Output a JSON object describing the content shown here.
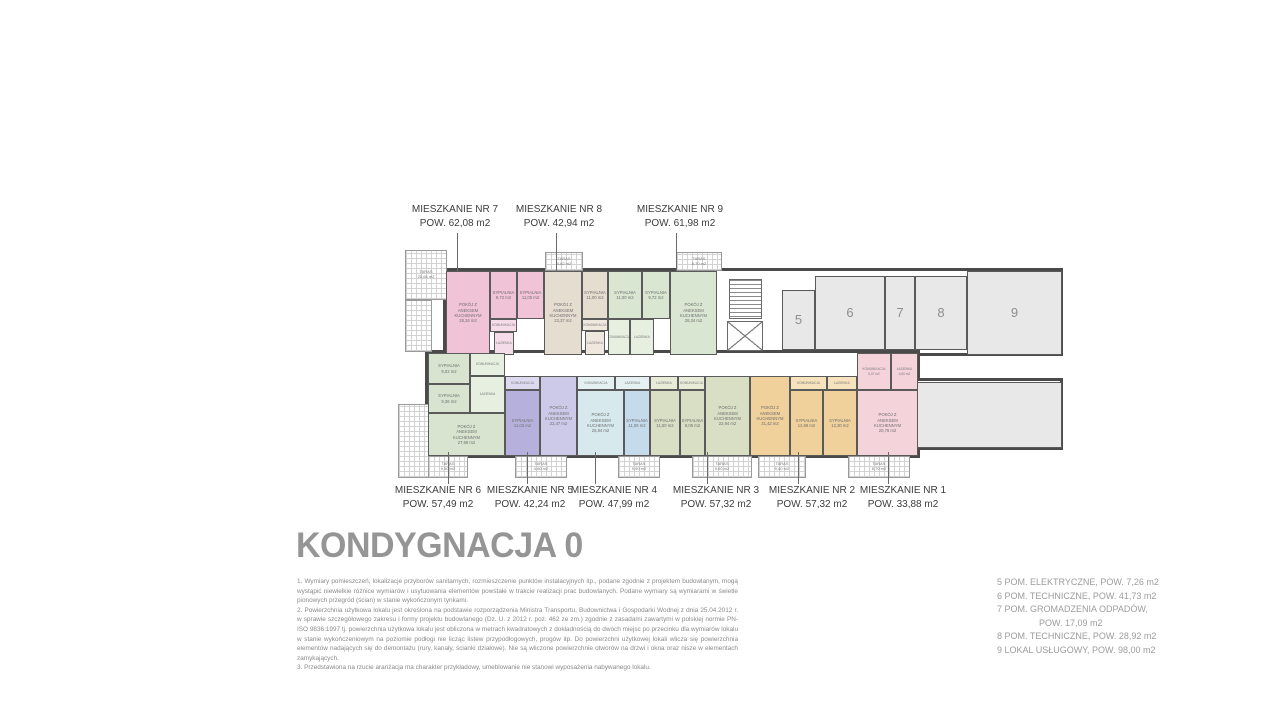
{
  "title": "KONDYGNACJA 0",
  "callouts": {
    "top": [
      {
        "name": "apartment-label-7",
        "title": "MIESZKANIE NR 7",
        "area": "POW. 62,08 m2",
        "cx": 455,
        "leader_x": 457
      },
      {
        "name": "apartment-label-8",
        "title": "MIESZKANIE NR 8",
        "area": "POW. 42,94 m2",
        "cx": 559,
        "leader_x": 556
      },
      {
        "name": "apartment-label-9",
        "title": "MIESZKANIE NR 9",
        "area": "POW. 61,98 m2",
        "cx": 680,
        "leader_x": 676
      }
    ],
    "bottom": [
      {
        "name": "apartment-label-6",
        "title": "MIESZKANIE NR 6",
        "area": "POW. 57,49 m2",
        "cx": 438,
        "leader_x": 448
      },
      {
        "name": "apartment-label-5",
        "title": "MIESZKANIE NR 5",
        "area": "POW. 42,24 m2",
        "cx": 530,
        "leader_x": 527
      },
      {
        "name": "apartment-label-4",
        "title": "MIESZKANIE NR 4",
        "area": "POW. 47,99 m2",
        "cx": 614,
        "leader_x": 595
      },
      {
        "name": "apartment-label-3",
        "title": "MIESZKANIE NR 3",
        "area": "POW. 57,32 m2",
        "cx": 716,
        "leader_x": 707
      },
      {
        "name": "apartment-label-2",
        "title": "MIESZKANIE NR 2",
        "area": "POW. 57,32 m2",
        "cx": 812,
        "leader_x": 798
      },
      {
        "name": "apartment-label-1",
        "title": "MIESZKANIE NR 1",
        "area": "POW. 33,88 m2",
        "cx": 903,
        "leader_x": 888
      }
    ]
  },
  "legend": {
    "items": [
      {
        "text": "5 POM. ELEKTRYCZNE, POW. 7,26 m2"
      },
      {
        "text": "6 POM. TECHNICZNE, POW. 41,73 m2"
      },
      {
        "text": "7 POM. GROMADZENIA ODPADÓW,",
        "text2": "POW. 17,09 m2"
      },
      {
        "text": "8 POM. TECHNICZNE, POW. 28,92 m2"
      },
      {
        "text": "9 LOKAL USŁUGOWY, POW. 98,00 m2"
      }
    ]
  },
  "notes": [
    "1. Wymiary pomieszczeń, lokalizacje przyborów sanitarnych, rozmieszczenie punktów instalacyjnych itp., podane zgodnie z projektem budowlanym, mogą wystąpić niewielkie różnice wymiarów i usytuowania elementów powstałe w trakcie realizacji prac budowlanych. Podane wymiary są wymiarami w świetle pionowych przegród (ścian) w stanie wykończonym tynkami.",
    "2. Powierzchnia użytkowa lokalu jest określona na podstawie rozporządzenia Ministra Transportu, Budownictwa i Gospodarki Wodnej z dnia 25.04.2012 r. w sprawie szczegółowego zakresu i formy projektu budowlanego (Dz. U. z 2012 r. poz. 462 ze zm.) zgodnie z zasadami zawartymi w polskiej normie PN-ISO 9836:1997 tj. powierzchnia użytkowa lokalu jest obliczona w metrach kwadratowych z dokładnością do dwóch miejsc po przecinku dla wymiarów lokalu w stanie wykończeniowym na poziomie podłogi nie licząc listew przypodłogowych, progów itp. Do powierzchni użytkowej lokali wlicza się powierzchnia elementów nadających się do demontażu (rury, kanały, ścianki działowe). Nie są wliczone powierzchnie otworów na drzwi i okna oraz nisze w elementach zamykających.",
    "3. Przedstawiona na rzucie aranżacja ma charakter przykładowy, umeblowanie nie stanowi wyposażenia nabywanego lokalu."
  ],
  "plan": {
    "outlines": [
      {
        "name": "building-top-wing",
        "x": 443,
        "y": 268,
        "w": 620,
        "h": 88
      },
      {
        "name": "building-bottom-wing",
        "x": 425,
        "y": 350,
        "w": 495,
        "h": 108
      },
      {
        "name": "building-right-wing",
        "x": 885,
        "y": 378,
        "w": 178,
        "h": 72
      }
    ],
    "rooms": [
      {
        "name": "apt7-living",
        "label": "POKÓJ Z\nANEKSEM\nKUCHENNYM\n28,34 m2",
        "x": 446,
        "y": 271,
        "w": 44,
        "h": 84,
        "fill": "#f0c3d7"
      },
      {
        "name": "apt7-bedroom-1",
        "label": "SYPIALNIA\n9,72 m2",
        "x": 490,
        "y": 271,
        "w": 27,
        "h": 48,
        "fill": "#f0c3d7"
      },
      {
        "name": "apt7-bedroom-2",
        "label": "SYPIALNIA\n11,00 m2",
        "x": 517,
        "y": 271,
        "w": 27,
        "h": 48,
        "fill": "#f0c3d7"
      },
      {
        "name": "apt7-hall",
        "label": "KOMUNIKACJA",
        "x": 490,
        "y": 319,
        "w": 27,
        "h": 13,
        "fill": "#f6dce8",
        "wet": true
      },
      {
        "name": "apt7-bathroom",
        "label": "ŁAZIENKA",
        "x": 494,
        "y": 332,
        "w": 20,
        "h": 23,
        "fill": "#f6dce8",
        "wet": true
      },
      {
        "name": "apt8-living",
        "label": "POKÓJ Z\nANEKSEM\nKUCHENNYM\n23,37 m2",
        "x": 544,
        "y": 271,
        "w": 38,
        "h": 84,
        "fill": "#e6ddd1"
      },
      {
        "name": "apt8-bedroom",
        "label": "SYPIALNIA\n11,00 m2",
        "x": 582,
        "y": 271,
        "w": 26,
        "h": 48,
        "fill": "#e6ddd1"
      },
      {
        "name": "apt8-hall",
        "label": "KOMUNIKACJA",
        "x": 582,
        "y": 319,
        "w": 26,
        "h": 12,
        "fill": "#efe8df",
        "wet": true
      },
      {
        "name": "apt8-bathroom",
        "label": "ŁAZIENKA",
        "x": 585,
        "y": 331,
        "w": 20,
        "h": 24,
        "fill": "#efe8df",
        "wet": true
      },
      {
        "name": "apt9-bedroom-1",
        "label": "SYPIALNIA\n11,00 m2",
        "x": 608,
        "y": 271,
        "w": 34,
        "h": 48,
        "fill": "#d9e6d2"
      },
      {
        "name": "apt9-bedroom-2",
        "label": "SYPIALNIA\n9,72 m2",
        "x": 642,
        "y": 271,
        "w": 28,
        "h": 48,
        "fill": "#d9e6d2"
      },
      {
        "name": "apt9-living",
        "label": "POKÓJ Z\nANEKSEM\nKUCHENNYM\n28,34 m2",
        "x": 670,
        "y": 271,
        "w": 47,
        "h": 84,
        "fill": "#d9e6d2"
      },
      {
        "name": "apt9-hall",
        "label": "KOMUNIKACJA",
        "x": 608,
        "y": 319,
        "w": 22,
        "h": 36,
        "fill": "#e6efe0",
        "wet": true
      },
      {
        "name": "apt9-bathroom",
        "label": "ŁAZIENKA",
        "x": 630,
        "y": 319,
        "w": 24,
        "h": 36,
        "fill": "#e6efe0",
        "wet": true
      },
      {
        "name": "room-5-electrical",
        "label": "5",
        "x": 782,
        "y": 290,
        "w": 33,
        "h": 60,
        "fill": "#e8e8e8",
        "number": true
      },
      {
        "name": "room-6-technical",
        "label": "6",
        "x": 815,
        "y": 276,
        "w": 70,
        "h": 74,
        "fill": "#e8e8e8",
        "number": true
      },
      {
        "name": "room-7-waste",
        "label": "7",
        "x": 885,
        "y": 276,
        "w": 30,
        "h": 74,
        "fill": "#e8e8e8",
        "number": true
      },
      {
        "name": "room-8-technical",
        "label": "8",
        "x": 915,
        "y": 276,
        "w": 52,
        "h": 74,
        "fill": "#e8e8e8",
        "number": true
      },
      {
        "name": "room-9-service",
        "label": "9",
        "x": 967,
        "y": 271,
        "w": 95,
        "h": 84,
        "fill": "#e8e8e8",
        "number": true
      },
      {
        "name": "room-9-service-lower",
        "label": "",
        "x": 888,
        "y": 382,
        "w": 174,
        "h": 66,
        "fill": "#e8e8e8"
      },
      {
        "name": "apt6-bedroom-1",
        "label": "SYPIALNIA\n9,02 m2",
        "x": 428,
        "y": 353,
        "w": 42,
        "h": 31,
        "fill": "#d9e4d0"
      },
      {
        "name": "apt6-bedroom-2",
        "label": "SYPIALNIA\n9,36 m2",
        "x": 428,
        "y": 384,
        "w": 42,
        "h": 29,
        "fill": "#d9e4d0"
      },
      {
        "name": "apt6-living",
        "label": "POKÓJ Z\nANEKSEM\nKUCHENNYM\n27,68 m2",
        "x": 428,
        "y": 413,
        "w": 77,
        "h": 43,
        "fill": "#d9e4d0"
      },
      {
        "name": "apt6-hall",
        "label": "KOMUNIKACJA",
        "x": 470,
        "y": 353,
        "w": 35,
        "h": 23,
        "fill": "#e6efe0",
        "wet": true
      },
      {
        "name": "apt6-bathroom",
        "label": "ŁAZIENKA",
        "x": 470,
        "y": 376,
        "w": 35,
        "h": 37,
        "fill": "#e6efe0",
        "wet": true
      },
      {
        "name": "apt5-hall",
        "label": "KOMUNIKACJA",
        "x": 505,
        "y": 376,
        "w": 35,
        "h": 14,
        "fill": "#dddaf0",
        "wet": true
      },
      {
        "name": "apt5-bedroom",
        "label": "SYPIALNIA\n11,03 m2",
        "x": 505,
        "y": 390,
        "w": 35,
        "h": 66,
        "fill": "#b6b1dc"
      },
      {
        "name": "apt5-living",
        "label": "POKÓJ Z\nANEKSEM\nKUCHENNYM\n22,47 m2",
        "x": 540,
        "y": 376,
        "w": 37,
        "h": 80,
        "fill": "#cdcae9"
      },
      {
        "name": "apt4-hall",
        "label": "KOMUNIKACJA",
        "x": 577,
        "y": 376,
        "w": 38,
        "h": 14,
        "fill": "#e4f0f2",
        "wet": true
      },
      {
        "name": "apt4-bathroom",
        "label": "ŁAZIENKA",
        "x": 615,
        "y": 376,
        "w": 35,
        "h": 14,
        "fill": "#e4f0f2",
        "wet": true
      },
      {
        "name": "apt4-living",
        "label": "POKÓJ Z\nANEKSEM\nKUCHENNYM\n26,84 m2",
        "x": 577,
        "y": 390,
        "w": 47,
        "h": 66,
        "fill": "#d7e9ed"
      },
      {
        "name": "apt4-bedroom",
        "label": "SYPIALNIA\n11,06 m2",
        "x": 624,
        "y": 390,
        "w": 26,
        "h": 66,
        "fill": "#c5daeb"
      },
      {
        "name": "apt3-bathroom",
        "label": "ŁAZIENKA",
        "x": 650,
        "y": 376,
        "w": 28,
        "h": 14,
        "fill": "#e7ebd8",
        "wet": true
      },
      {
        "name": "apt3-hall",
        "label": "KOMUNIKACJA",
        "x": 678,
        "y": 376,
        "w": 27,
        "h": 14,
        "fill": "#e7ebd8",
        "wet": true
      },
      {
        "name": "apt3-bedroom-1",
        "label": "SYPIALNIA\n11,50 m2",
        "x": 650,
        "y": 390,
        "w": 30,
        "h": 66,
        "fill": "#d8dfc4"
      },
      {
        "name": "apt3-bedroom-2",
        "label": "SYPIALNIA\n8,05 m2",
        "x": 680,
        "y": 390,
        "w": 25,
        "h": 66,
        "fill": "#d8dfc4"
      },
      {
        "name": "apt3-living",
        "label": "POKÓJ Z\nANEKSEM\nKUCHENNYM\n22,94 m2",
        "x": 705,
        "y": 376,
        "w": 45,
        "h": 80,
        "fill": "#d8dfc4"
      },
      {
        "name": "apt2-living",
        "label": "POKÓJ Z\nANEKSEM\nKUCHENNYM\n31,42 m2",
        "x": 750,
        "y": 376,
        "w": 40,
        "h": 80,
        "fill": "#f0d09b"
      },
      {
        "name": "apt2-hall",
        "label": "KOMUNIKACJA",
        "x": 790,
        "y": 376,
        "w": 37,
        "h": 14,
        "fill": "#f6e2bd",
        "wet": true
      },
      {
        "name": "apt2-bathroom",
        "label": "ŁAZIENKA",
        "x": 827,
        "y": 376,
        "w": 30,
        "h": 14,
        "fill": "#f6e2bd",
        "wet": true
      },
      {
        "name": "apt2-bedroom-1",
        "label": "SYPIALNIA\n12,69 m2",
        "x": 790,
        "y": 390,
        "w": 33,
        "h": 66,
        "fill": "#f0d09b"
      },
      {
        "name": "apt2-bedroom-2",
        "label": "SYPIALNIA\n12,30 m2",
        "x": 823,
        "y": 390,
        "w": 34,
        "h": 66,
        "fill": "#f0d09b"
      },
      {
        "name": "apt1-hall",
        "label": "KOMUNIKACJA\n6,07 m2",
        "x": 857,
        "y": 353,
        "w": 34,
        "h": 37,
        "fill": "#f4d3da",
        "wet": true
      },
      {
        "name": "apt1-bathroom",
        "label": "ŁAZIENKA\n4,60 m2",
        "x": 891,
        "y": 353,
        "w": 27,
        "h": 37,
        "fill": "#f4d3da",
        "wet": true
      },
      {
        "name": "apt1-living",
        "label": "POKÓJ Z\nANEKSEM\nKUCHENNYM\n20,76 m2",
        "x": 857,
        "y": 390,
        "w": 61,
        "h": 66,
        "fill": "#f4d3da"
      }
    ],
    "terraces": [
      {
        "name": "terrace-top-left",
        "label": "TARAS\n20,66 m2",
        "x": 405,
        "y": 250,
        "w": 42,
        "h": 50
      },
      {
        "name": "terrace-left-side",
        "label": "",
        "x": 405,
        "y": 300,
        "w": 27,
        "h": 52
      },
      {
        "name": "terrace-top-apt8",
        "label": "TARAS\n4,82 m2",
        "x": 545,
        "y": 252,
        "w": 38,
        "h": 19
      },
      {
        "name": "terrace-top-apt9",
        "label": "TARAS\n8,70 m2",
        "x": 676,
        "y": 252,
        "w": 46,
        "h": 19
      },
      {
        "name": "terrace-bottom-left",
        "label": "",
        "x": 398,
        "y": 404,
        "w": 44,
        "h": 74
      },
      {
        "name": "terrace-apt6",
        "label": "TARAS\n9,50 m2",
        "x": 428,
        "y": 456,
        "w": 40,
        "h": 22
      },
      {
        "name": "terrace-apt5",
        "label": "TARAS\n4,60 m2",
        "x": 515,
        "y": 456,
        "w": 52,
        "h": 22
      },
      {
        "name": "terrace-apt4",
        "label": "TARAS\n9,90 m2",
        "x": 618,
        "y": 456,
        "w": 42,
        "h": 22
      },
      {
        "name": "terrace-apt3",
        "label": "TARAS\n9,60 m2",
        "x": 692,
        "y": 456,
        "w": 60,
        "h": 22
      },
      {
        "name": "terrace-apt2",
        "label": "TARAS\n9,40 m2",
        "x": 758,
        "y": 456,
        "w": 48,
        "h": 22
      },
      {
        "name": "terrace-apt1",
        "label": "TARAS\n8,70 m2",
        "x": 848,
        "y": 456,
        "w": 62,
        "h": 22
      }
    ],
    "features": [
      {
        "name": "staircase-icon",
        "type": "stairs",
        "x": 729,
        "y": 279,
        "w": 33,
        "h": 40
      },
      {
        "name": "elevator-icon",
        "type": "elevator",
        "x": 727,
        "y": 321,
        "w": 36,
        "h": 30
      }
    ],
    "leaders": {
      "top": {
        "y1": 233,
        "y2": 271
      },
      "bottom": {
        "y1": 452,
        "y2": 484
      }
    }
  }
}
